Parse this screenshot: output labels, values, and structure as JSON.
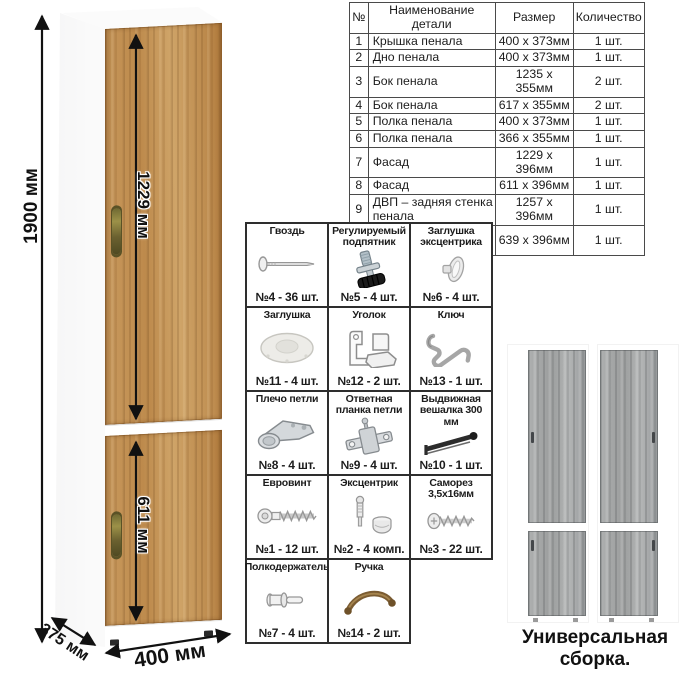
{
  "parts_table": {
    "headers": [
      "№",
      "Наименование детали",
      "Размер",
      "Количество"
    ],
    "rows": [
      [
        "1",
        "Крышка пенала",
        "400 x 373мм",
        "1 шт."
      ],
      [
        "2",
        "Дно пенала",
        "400 x 373мм",
        "1 шт."
      ],
      [
        "3",
        "Бок пенала",
        "1235 x 355мм",
        "2 шт."
      ],
      [
        "4",
        "Бок пенала",
        "617 x 355мм",
        "2 шт."
      ],
      [
        "5",
        "Полка пенала",
        "400 x 373мм",
        "1 шт."
      ],
      [
        "6",
        "Полка пенала",
        "366 x 355мм",
        "1 шт."
      ],
      [
        "7",
        "Фасад",
        "1229 x 396мм",
        "1 шт."
      ],
      [
        "8",
        "Фасад",
        "611 x 396мм",
        "1 шт."
      ],
      [
        "9",
        "ДВП – задняя стенка пенала",
        "1257 x 396мм",
        "1 шт."
      ],
      [
        "10",
        "ДВП – задняя стенка пенала",
        "639 x 396мм",
        "1 шт."
      ]
    ]
  },
  "dimensions": {
    "height": "1900 мм",
    "upper_door": "1229 мм",
    "lower_door": "611 мм",
    "depth": "375 мм",
    "width": "400 мм"
  },
  "hardware": {
    "items": [
      {
        "name": "Гвоздь",
        "qty": "№4 - 36 шт.",
        "icon": "nail-icon"
      },
      {
        "name": "Регулируемый подпятник",
        "qty": "№5 - 4 шт.",
        "icon": "adjustable-foot-icon"
      },
      {
        "name": "Заглушка эксцентрика",
        "qty": "№6 - 4 шт.",
        "icon": "cam-cap-icon"
      },
      {
        "name": "Заглушка",
        "qty": "№11 - 4 шт.",
        "icon": "plug-cap-icon"
      },
      {
        "name": "Уголок",
        "qty": "№12 - 2 шт.",
        "icon": "corner-bracket-icon"
      },
      {
        "name": "Ключ",
        "qty": "№13 - 1 шт.",
        "icon": "hex-key-icon"
      },
      {
        "name": "Плечо петли",
        "qty": "№8 - 4 шт.",
        "icon": "hinge-arm-icon"
      },
      {
        "name": "Ответная планка петли",
        "qty": "№9 - 4 шт.",
        "icon": "hinge-plate-icon"
      },
      {
        "name": "Выдвижная вешалка 300 мм",
        "qty": "№10 - 1 шт.",
        "icon": "pullout-hanger-icon"
      },
      {
        "name": "Евровинт",
        "qty": "№1 - 12 шт.",
        "icon": "euro-screw-icon"
      },
      {
        "name": "Эксцентрик",
        "qty": "№2 - 4 комп.",
        "icon": "cam-lock-icon"
      },
      {
        "name": "Саморез 3,5х16мм",
        "qty": "№3 - 22 шт.",
        "icon": "screw-icon"
      },
      {
        "name": "Полкодержатель",
        "qty": "№7 - 4 шт.",
        "icon": "shelf-pin-icon"
      },
      {
        "name": "Ручка",
        "qty": "№14 - 2 шт.",
        "icon": "handle-icon"
      }
    ]
  },
  "caption": "Универсальная сборка.",
  "colors": {
    "wood": "#c1914f",
    "gray_wood": "#a6a8a8",
    "arrow": "#111111",
    "table_border": "#4a4a4a",
    "handle_bronze": "#7b5c32"
  }
}
